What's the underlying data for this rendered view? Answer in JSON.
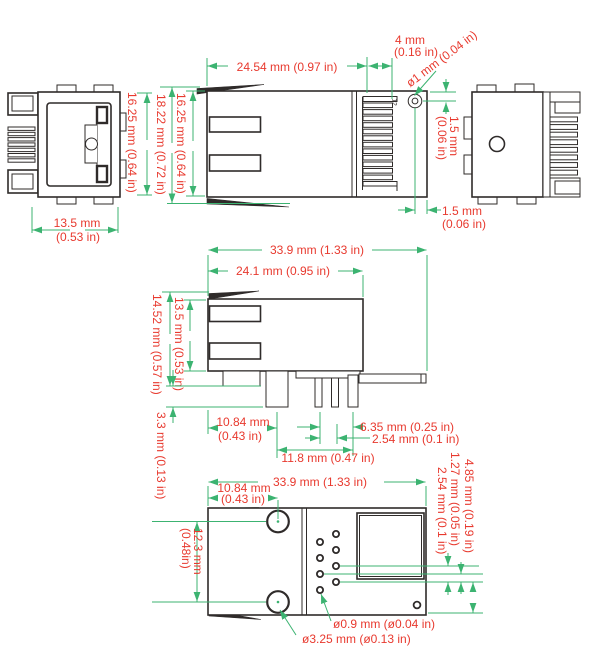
{
  "colors": {
    "dimension_line": "#3cb371",
    "dimension_text": "#e8392e",
    "outline": "#2f2b2a",
    "background": "#ffffff"
  },
  "dims": {
    "front": {
      "width1": "13.5 mm",
      "width2": "(0.53 in)",
      "height": "16.25 mm (0.64 in)"
    },
    "side": {
      "length": "24.54 mm (0.97 in)",
      "overall_height": "18.22 mm (0.72 in)",
      "body_height": "16.25 mm (0.64 in)",
      "contact_zone1": "4 mm",
      "contact_zone2": "(0.16 in)",
      "hole_dia": "ø1 mm (0.04 in)",
      "hole_top1": "1.5 mm",
      "hole_top2": "(0.06 in)",
      "hole_edge1": "1.5 mm",
      "hole_edge2": "(0.06 in)"
    },
    "profile": {
      "total_length": "33.9 mm (1.33 in)",
      "housing_length": "24.1 mm (0.95 in)",
      "total_height": "14.52 mm (0.57 in)",
      "body_height": "13.5 mm (0.53 in)",
      "post_offset1": "10.84 mm",
      "post_offset2": "(0.43 in)",
      "pin_row_width": "6.35 mm (0.25 in)",
      "pin_pitch": "2.54 mm (0.1 in)",
      "pin_span": "11.8 mm (0.47 in)",
      "pin_length": "3.3 mm (0.13 in)"
    },
    "bottom": {
      "total_length": "33.9 mm (1.33 in)",
      "hole_offset1": "10.84 mm",
      "hole_offset2": "(0.43 in)",
      "hole_spacing1": "12.3 mm",
      "hole_spacing2": "(0.48in)",
      "pitch": "2.54 mm (0.1 in)",
      "stagger": "1.27 mm (0.05 in)",
      "edge_dist": "4.85 mm (0.19 in)",
      "small_hole": "ø0.9 mm (ø0.04 in)",
      "large_hole": "ø3.25 mm (ø0.13 in)"
    }
  },
  "annotations": {
    "contact_number": "12"
  }
}
